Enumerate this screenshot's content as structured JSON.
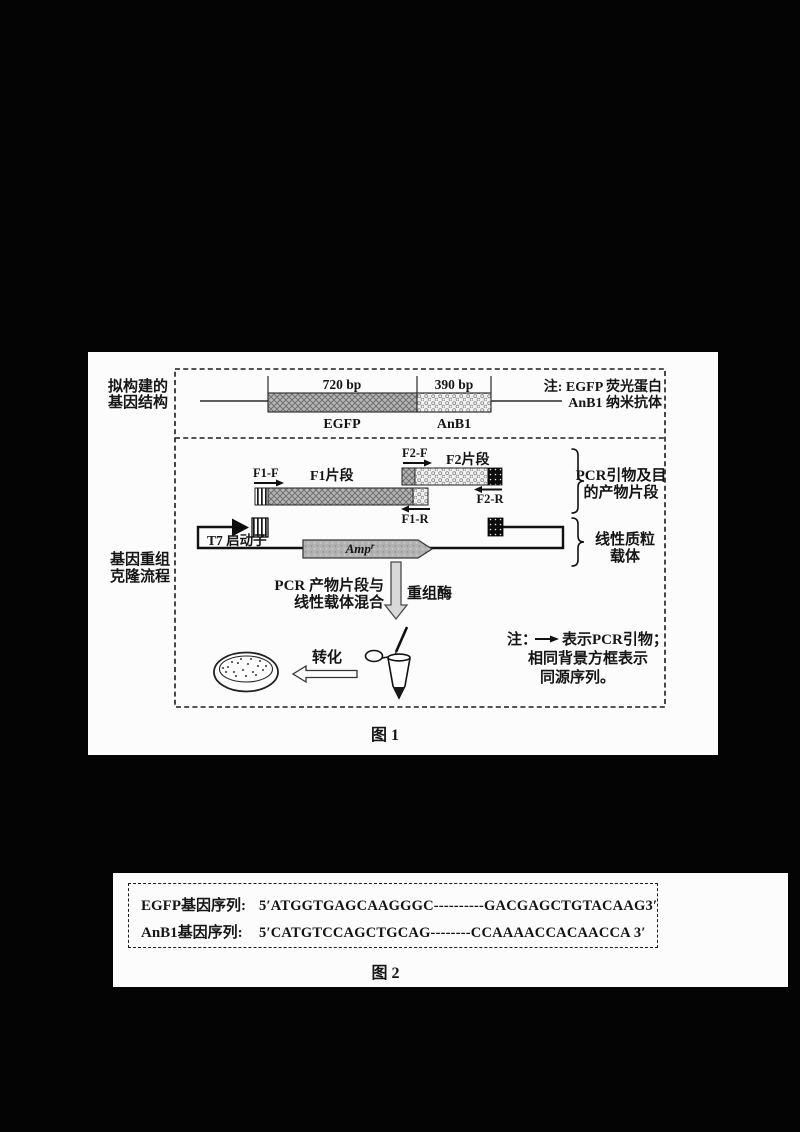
{
  "page": {
    "background": "#040404",
    "paper_color": "#fcfcfc"
  },
  "figure1": {
    "caption": "图 1",
    "row_labels": {
      "structure_l1": "拟构建的",
      "structure_l2": "基因结构",
      "process_l1": "基因重组",
      "process_l2": "克隆流程"
    },
    "gene_structure": {
      "egfp_bp": "720 bp",
      "anb1_bp": "390 bp",
      "egfp": "EGFP",
      "anb1": "AnB1",
      "note_l1": "注: EGFP 荧光蛋白",
      "note_l2": "AnB1 纳米抗体"
    },
    "pcr_section": {
      "f1f": "F1-F",
      "f1r": "F1-R",
      "f2f": "F2-F",
      "f2r": "F2-R",
      "f1": "F1片段",
      "f2": "F2片段",
      "bracket_l1": "PCR引物及目",
      "bracket_l2": "的产物片段"
    },
    "vector_section": {
      "t7": "T7 启动子",
      "amp_main": "Amp",
      "amp_sup": "r",
      "bracket_l1": "线性质粒",
      "bracket_l2": "载体"
    },
    "process": {
      "mix_l1": "PCR 产物片段与",
      "mix_l2": "线性载体混合",
      "enzyme": "重组酶",
      "transform": "转化",
      "note_prefix": "注：",
      "note_l1": "表示PCR引物；",
      "note_l2": "相同背景方框表示",
      "note_l3": "同源序列。"
    }
  },
  "figure2": {
    "caption": "图 2",
    "rows": [
      {
        "label": "EGFP基因序列:",
        "sequence": "5′ATGGTGAGCAAGGGC----------GACGAGCTGTACAAG3′"
      },
      {
        "label": "AnB1基因序列:",
        "sequence": "5′CATGTCCAGCTGCAG--------CCAAAACCACAACCA 3′"
      }
    ]
  }
}
